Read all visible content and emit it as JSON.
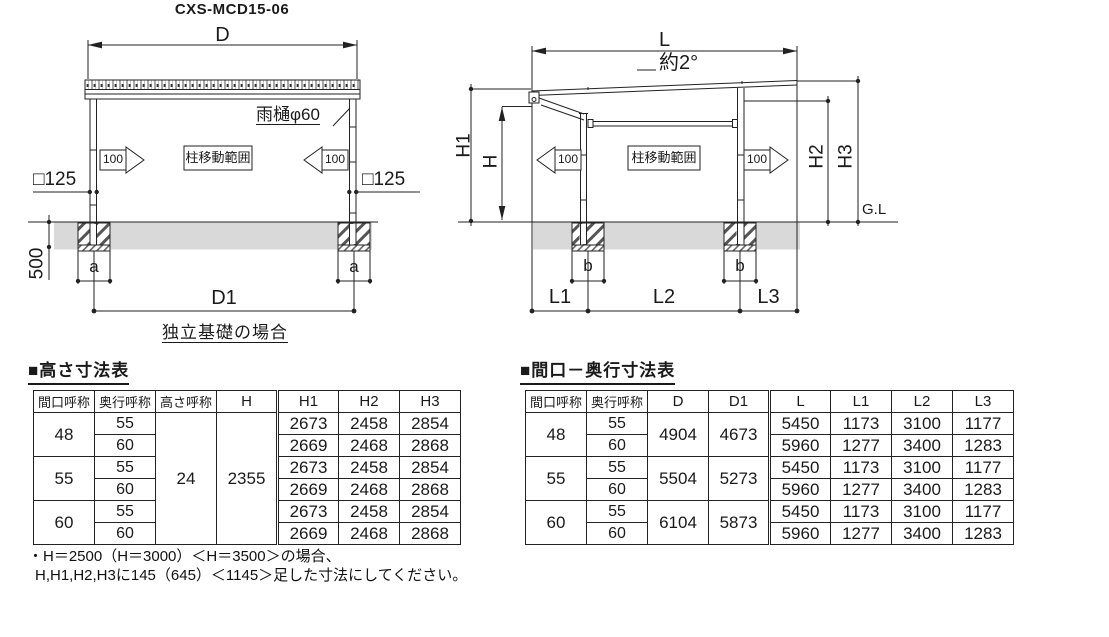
{
  "title": "CXS-MCD15-06",
  "colors": {
    "line": "#222222",
    "ground_fill": "#d9d9d9"
  },
  "front_view": {
    "dim_d": "D",
    "dim_d1": "D1",
    "dim_depth": "500",
    "dim_a_left": "a",
    "dim_a_right": "a",
    "col_size_left": "□125",
    "col_size_right": "□125",
    "gutter_label": "雨樋φ60",
    "move_left": "100",
    "move_right": "100",
    "column_range": "柱移動範囲",
    "caption": "独立基礎の場合"
  },
  "side_view": {
    "dim_l": "L",
    "slope": "約2°",
    "dim_h1": "H1",
    "dim_h": "H",
    "dim_h2": "H2",
    "dim_h3": "H3",
    "ground_line": "G.L",
    "move_left": "100",
    "move_right": "100",
    "column_range": "柱移動範囲",
    "dim_b_left": "b",
    "dim_b_right": "b",
    "dim_l1": "L1",
    "dim_l2": "L2",
    "dim_l3": "L3"
  },
  "height_table": {
    "title": "■高さ寸法表",
    "headers": [
      "間口呼称",
      "奥行呼称",
      "高さ呼称",
      "H",
      "H1",
      "H2",
      "H3"
    ],
    "height_name": "24",
    "h": "2355",
    "groups": [
      {
        "label": "48",
        "rows": [
          {
            "depth": "55",
            "h1": "2673",
            "h2": "2458",
            "h3": "2854"
          },
          {
            "depth": "60",
            "h1": "2669",
            "h2": "2468",
            "h3": "2868"
          }
        ]
      },
      {
        "label": "55",
        "rows": [
          {
            "depth": "55",
            "h1": "2673",
            "h2": "2458",
            "h3": "2854"
          },
          {
            "depth": "60",
            "h1": "2669",
            "h2": "2468",
            "h3": "2868"
          }
        ]
      },
      {
        "label": "60",
        "rows": [
          {
            "depth": "55",
            "h1": "2673",
            "h2": "2458",
            "h3": "2854"
          },
          {
            "depth": "60",
            "h1": "2669",
            "h2": "2468",
            "h3": "2868"
          }
        ]
      }
    ]
  },
  "span_table": {
    "title": "■間口－奥行寸法表",
    "headers": [
      "間口呼称",
      "奥行呼称",
      "D",
      "D1",
      "L",
      "L1",
      "L2",
      "L3"
    ],
    "groups": [
      {
        "label": "48",
        "d": "4904",
        "d1": "4673",
        "rows": [
          {
            "depth": "55",
            "l": "5450",
            "l1": "1173",
            "l2": "3100",
            "l3": "1177"
          },
          {
            "depth": "60",
            "l": "5960",
            "l1": "1277",
            "l2": "3400",
            "l3": "1283"
          }
        ]
      },
      {
        "label": "55",
        "d": "5504",
        "d1": "5273",
        "rows": [
          {
            "depth": "55",
            "l": "5450",
            "l1": "1173",
            "l2": "3100",
            "l3": "1177"
          },
          {
            "depth": "60",
            "l": "5960",
            "l1": "1277",
            "l2": "3400",
            "l3": "1283"
          }
        ]
      },
      {
        "label": "60",
        "d": "6104",
        "d1": "5873",
        "rows": [
          {
            "depth": "55",
            "l": "5450",
            "l1": "1173",
            "l2": "3100",
            "l3": "1177"
          },
          {
            "depth": "60",
            "l": "5960",
            "l1": "1277",
            "l2": "3400",
            "l3": "1283"
          }
        ]
      }
    ]
  },
  "notes": {
    "line1": "・H＝2500（H＝3000）＜H＝3500＞の場合、",
    "line2": "H,H1,H2,H3に145（645）＜1145＞足した寸法にしてください。"
  }
}
